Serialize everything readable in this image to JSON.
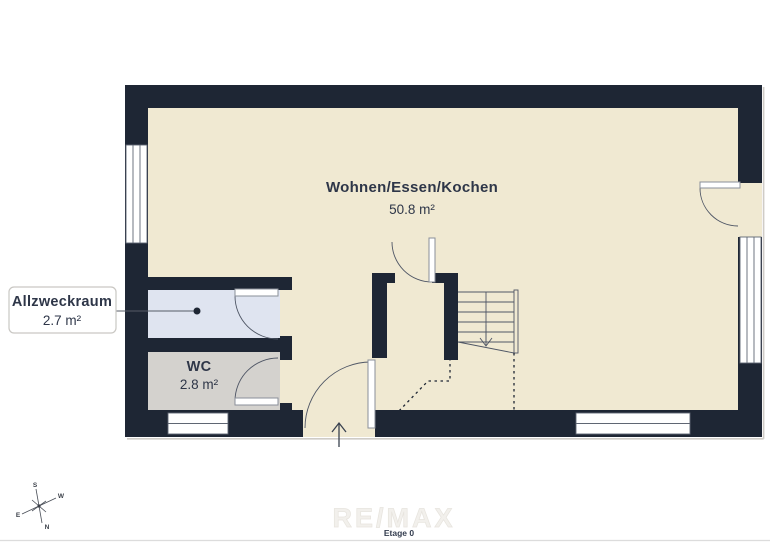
{
  "plan": {
    "main_room": {
      "name": "Wohnen/Essen/Kochen",
      "area": "50.8 m²"
    },
    "allzweckraum": {
      "name": "Allzweckraum",
      "area": "2.7 m²"
    },
    "wc": {
      "name": "WC",
      "area": "2.8 m²"
    },
    "floor_tab": "Etage 0",
    "watermark": "RE/MAX",
    "compass": {
      "north": "N",
      "south": "S",
      "east": "E",
      "west": "W"
    }
  },
  "colors": {
    "wall": "#1e2634",
    "floor": "#f0e9d2",
    "allzweck_floor": "#dfe4f0",
    "wc_floor": "#d4d2ce",
    "ink": "#2e3648"
  }
}
